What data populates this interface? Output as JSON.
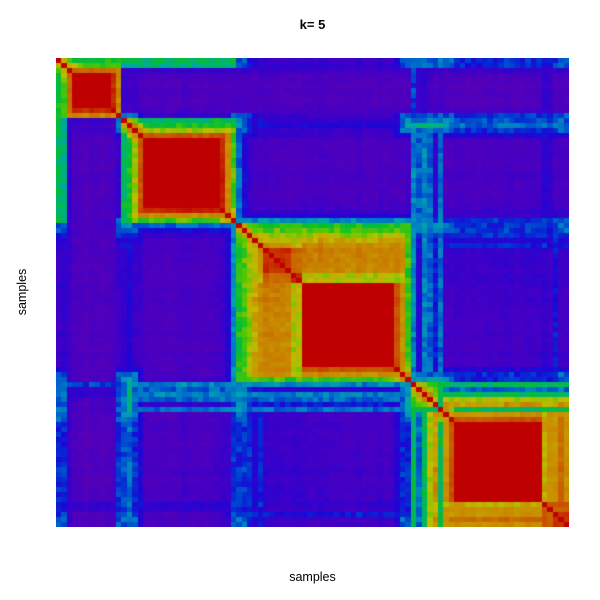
{
  "figure": {
    "background": "#ffffff",
    "text_color": "#000000"
  },
  "chart_data": {
    "type": "heatmap",
    "title": "k= 5",
    "xlabel": "samples",
    "ylabel": "samples",
    "k": 5,
    "n_samples": 94,
    "value_range": [
      0,
      1
    ],
    "grid": false,
    "legend": null,
    "cluster_sizes": [
      12,
      21,
      32,
      5,
      24
    ],
    "palette_stops": [
      [
        0.0,
        "#5A00B4"
      ],
      [
        0.08,
        "#4100C6"
      ],
      [
        0.16,
        "#1C06D6"
      ],
      [
        0.24,
        "#0035D2"
      ],
      [
        0.32,
        "#0078C8"
      ],
      [
        0.4,
        "#00A4AE"
      ],
      [
        0.47,
        "#00B46E"
      ],
      [
        0.54,
        "#06BE2E"
      ],
      [
        0.62,
        "#5AC800"
      ],
      [
        0.7,
        "#BEBE00"
      ],
      [
        0.79,
        "#C89100"
      ],
      [
        0.87,
        "#C85F00"
      ],
      [
        0.94,
        "#C83000"
      ],
      [
        1.0,
        "#BE0000"
      ]
    ],
    "sample_runs": [
      {
        "n": 1,
        "c": 1,
        "a": [
          0.55,
          0.5,
          0.1,
          0.3,
          0.06
        ]
      },
      {
        "n": 1,
        "c": 1,
        "a": [
          0.6,
          0.45,
          0.12,
          0.28,
          0.05
        ]
      },
      {
        "n": 1,
        "c": 1,
        "a": [
          0.85,
          0.1,
          0.05,
          0.1,
          0.03
        ]
      },
      {
        "n": 7,
        "c": 1,
        "a": [
          1.0,
          0.04,
          0.02,
          0.03,
          0.02
        ]
      },
      {
        "n": 1,
        "c": 1,
        "a": [
          0.95,
          0.06,
          0.03,
          0.06,
          0.02
        ]
      },
      {
        "n": 1,
        "c": 1,
        "a": [
          0.8,
          0.1,
          0.05,
          0.28,
          0.04
        ]
      },
      {
        "n": 1,
        "c": 2,
        "a": [
          0.1,
          0.5,
          0.12,
          0.35,
          0.28
        ]
      },
      {
        "n": 1,
        "c": 2,
        "a": [
          0.06,
          0.55,
          0.15,
          0.45,
          0.3
        ]
      },
      {
        "n": 1,
        "c": 2,
        "a": [
          0.08,
          0.68,
          0.1,
          0.3,
          0.08
        ]
      },
      {
        "n": 1,
        "c": 2,
        "a": [
          0.04,
          0.88,
          0.06,
          0.15,
          0.04
        ]
      },
      {
        "n": 14,
        "c": 2,
        "a": [
          0.03,
          1.0,
          0.04,
          0.06,
          0.02
        ]
      },
      {
        "n": 1,
        "c": 2,
        "a": [
          0.03,
          0.95,
          0.08,
          0.08,
          0.03
        ]
      },
      {
        "n": 1,
        "c": 2,
        "a": [
          0.04,
          0.8,
          0.15,
          0.1,
          0.04
        ]
      },
      {
        "n": 1,
        "c": 2,
        "a": [
          0.05,
          0.6,
          0.35,
          0.25,
          0.06
        ]
      },
      {
        "n": 1,
        "c": 3,
        "a": [
          0.05,
          0.3,
          0.55,
          0.35,
          0.2
        ]
      },
      {
        "n": 1,
        "c": 3,
        "a": [
          0.04,
          0.15,
          0.6,
          0.3,
          0.2
        ]
      },
      {
        "n": 1,
        "c": 3,
        "a": [
          0.04,
          0.1,
          0.68,
          0.22,
          0.08
        ]
      },
      {
        "n": 1,
        "c": 3,
        "a": [
          0.03,
          0.08,
          0.75,
          0.15,
          0.05
        ]
      },
      {
        "n": 1,
        "c": 3,
        "a": [
          0.02,
          0.06,
          0.8,
          0.1,
          0.2
        ]
      },
      {
        "n": 5,
        "c": 3,
        "a": [
          0.02,
          0.05,
          0.82,
          0.1,
          0.04
        ]
      },
      {
        "n": 2,
        "c": 3,
        "a": [
          0.02,
          0.05,
          0.7,
          0.11,
          0.04
        ]
      },
      {
        "n": 17,
        "c": 3,
        "a": [
          0.02,
          0.04,
          1.0,
          0.08,
          0.03
        ]
      },
      {
        "n": 1,
        "c": 3,
        "a": [
          0.02,
          0.05,
          0.9,
          0.15,
          0.04
        ]
      },
      {
        "n": 1,
        "c": 3,
        "a": [
          0.02,
          0.06,
          0.8,
          0.3,
          0.05
        ]
      },
      {
        "n": 1,
        "c": 3,
        "a": [
          0.03,
          0.08,
          0.6,
          0.4,
          0.1
        ]
      },
      {
        "n": 1,
        "c": 4,
        "a": [
          0.25,
          0.35,
          0.35,
          0.75,
          0.5
        ]
      },
      {
        "n": 1,
        "c": 4,
        "a": [
          0.1,
          0.3,
          0.15,
          0.7,
          0.32
        ]
      },
      {
        "n": 1,
        "c": 4,
        "a": [
          0.12,
          0.35,
          0.35,
          0.72,
          0.5
        ]
      },
      {
        "n": 1,
        "c": 4,
        "a": [
          0.06,
          0.3,
          0.3,
          0.78,
          0.7
        ]
      },
      {
        "n": 1,
        "c": 4,
        "a": [
          0.05,
          0.12,
          0.2,
          0.8,
          0.78
        ]
      },
      {
        "n": 1,
        "c": 5,
        "a": [
          0.06,
          0.3,
          0.3,
          0.5,
          0.5
        ]
      },
      {
        "n": 1,
        "c": 5,
        "a": [
          0.03,
          0.05,
          0.06,
          0.35,
          0.8
        ]
      },
      {
        "n": 1,
        "c": 5,
        "a": [
          0.02,
          0.04,
          0.05,
          0.3,
          0.9
        ]
      },
      {
        "n": 16,
        "c": 5,
        "a": [
          0.02,
          0.03,
          0.04,
          0.22,
          1.0
        ]
      },
      {
        "n": 1,
        "c": 5,
        "a": [
          0.1,
          0.12,
          0.1,
          0.2,
          0.72
        ]
      },
      {
        "n": 1,
        "c": 5,
        "a": [
          0.1,
          0.12,
          0.1,
          0.2,
          0.8
        ]
      },
      {
        "n": 1,
        "c": 5,
        "a": [
          0.03,
          0.05,
          0.2,
          0.25,
          0.8
        ]
      },
      {
        "n": 1,
        "c": 5,
        "a": [
          0.02,
          0.04,
          0.05,
          0.3,
          0.85
        ]
      },
      {
        "n": 1,
        "c": 5,
        "a": [
          0.03,
          0.05,
          0.05,
          0.3,
          0.8
        ]
      }
    ],
    "overrides": [
      {
        "i": [
          38,
          44
        ],
        "j": [
          38,
          44
        ],
        "v": 0.95
      },
      {
        "i": [
          43,
          44
        ],
        "j": [
          38,
          42
        ],
        "v": 0.87
      },
      {
        "i": [
          65,
          69
        ],
        "j": [
          65,
          69
        ],
        "v": 0.62
      },
      {
        "i": [
          89,
          90
        ],
        "j": [
          89,
          93
        ],
        "v": 0.88
      },
      {
        "i": [
          91,
          93
        ],
        "j": [
          91,
          93
        ],
        "v": 0.95
      }
    ],
    "noise": {
      "transition": 0.05,
      "flat": 0.018,
      "col": 0.012
    }
  }
}
